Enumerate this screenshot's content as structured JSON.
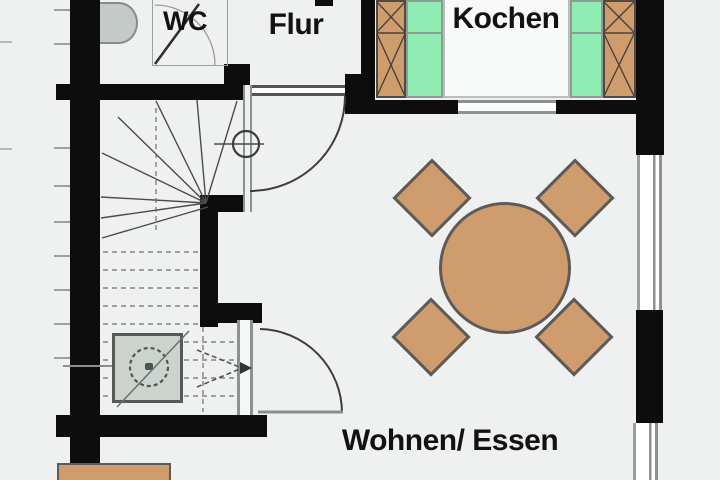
{
  "rooms": {
    "wc": {
      "label": "WC"
    },
    "flur": {
      "label": "Flur"
    },
    "kochen": {
      "label": "Kochen"
    },
    "wohnen_essen": {
      "label": "Wohnen/ Essen"
    }
  },
  "palette": {
    "background": "#eff1f0",
    "wall_black": "#0d0d0d",
    "furniture_brown": "#cf9c6e",
    "appliance_green": "#8fecb3",
    "fixture_gray": "#cbd2ce",
    "window_gray": "#8d928f"
  },
  "fixtures": {
    "washbasin": "washbasin",
    "shower": "shower-tray-with-drain",
    "stairs": "winder-staircase",
    "dining_table": "round-dining-table",
    "chairs_count": 4,
    "kitchen_counters": "kitchen-counter-run-with-appliances",
    "sideboard": "sideboard"
  }
}
